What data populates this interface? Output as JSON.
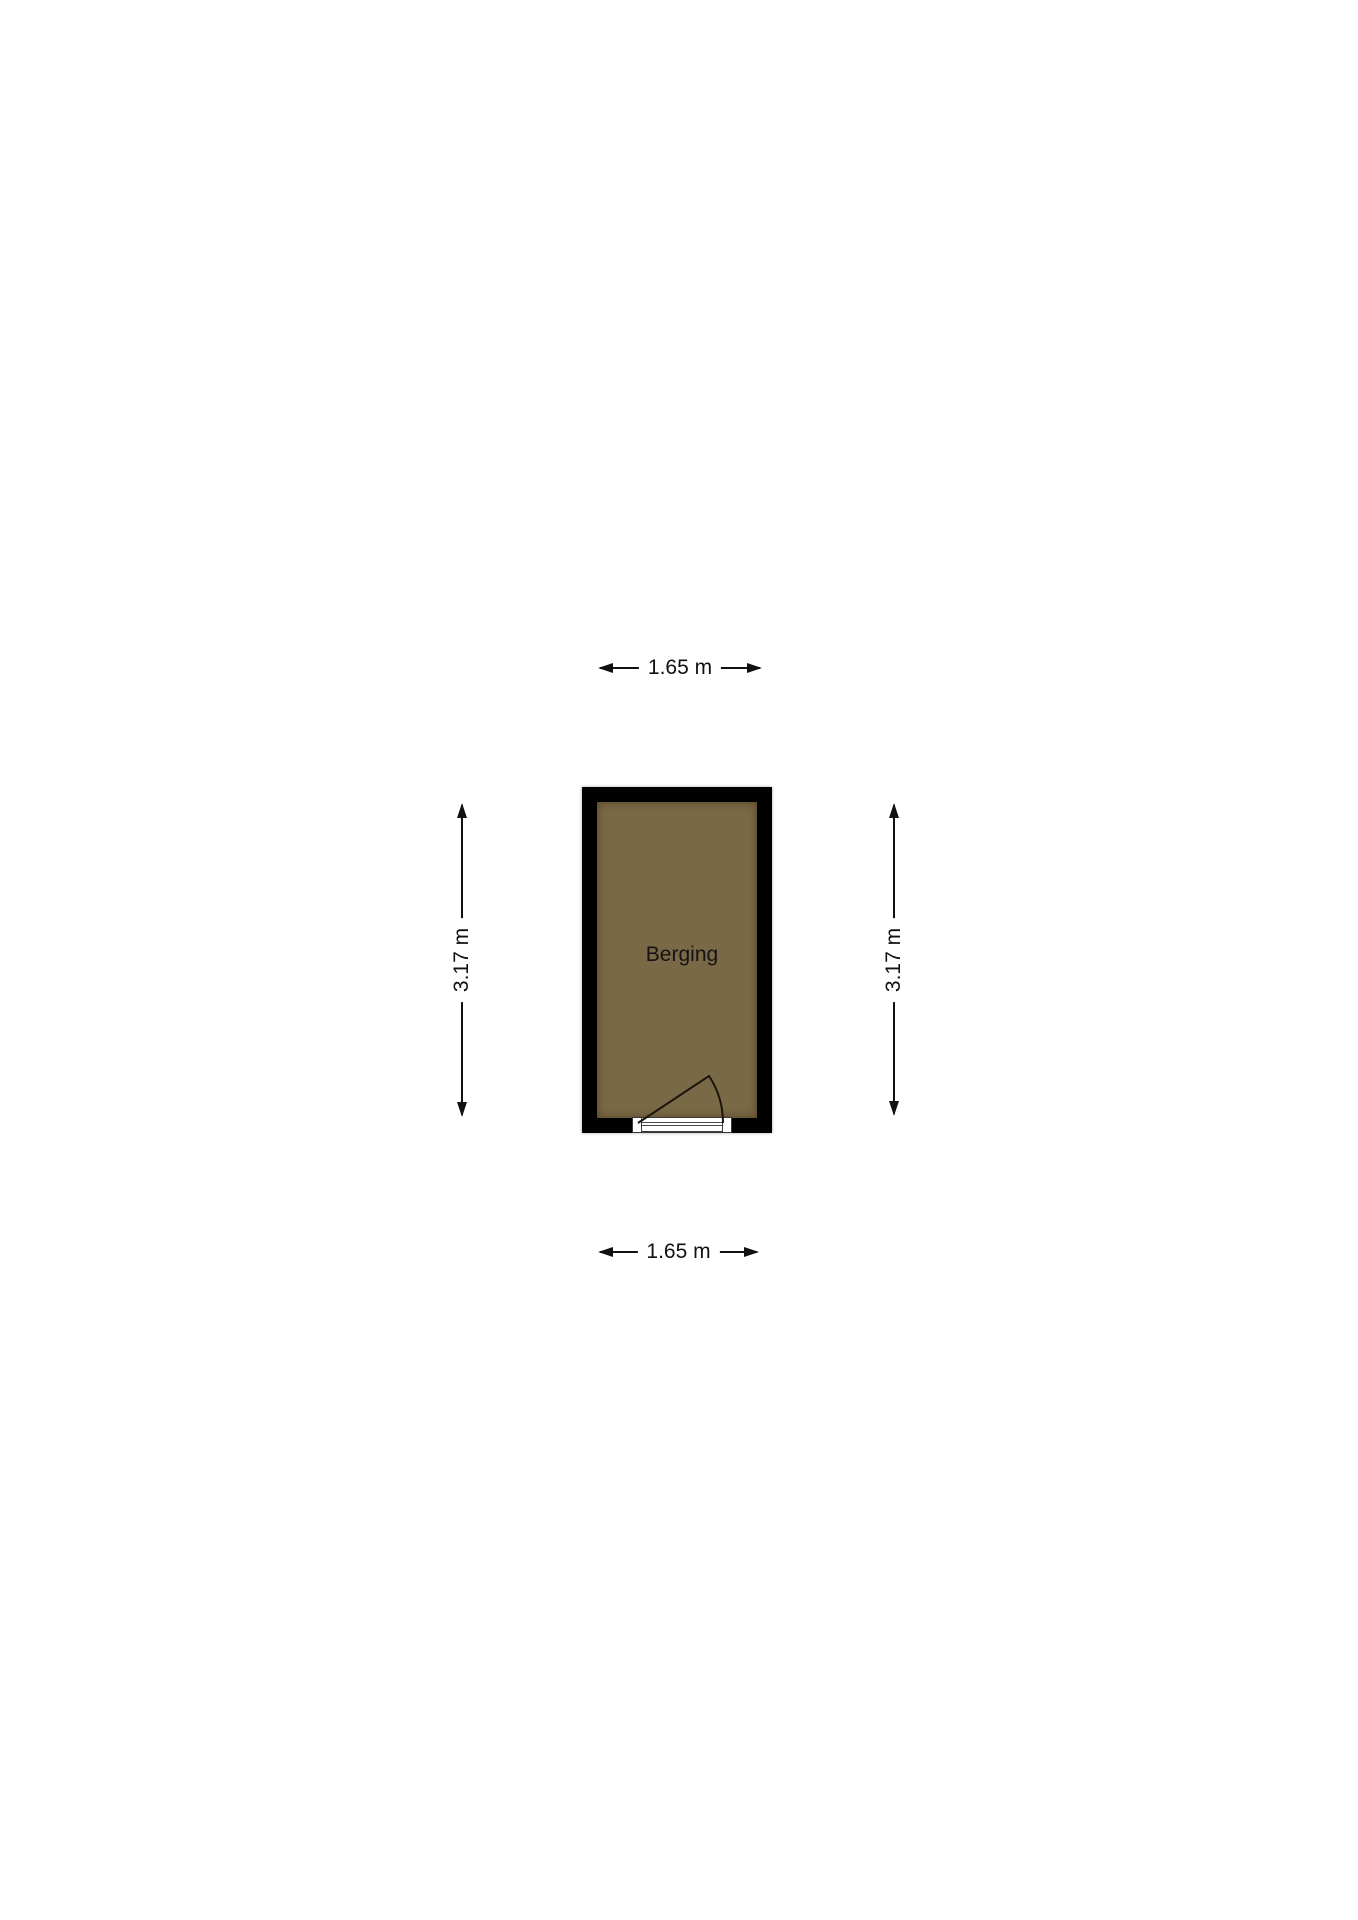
{
  "floorplan": {
    "room": {
      "label": "Berging",
      "wall_color": "#000000",
      "floor_color": "#7a6946"
    },
    "dimensions": {
      "width_top": "1.65 m",
      "width_bottom": "1.65 m",
      "height_left": "3.17 m",
      "height_right": "3.17 m"
    }
  }
}
